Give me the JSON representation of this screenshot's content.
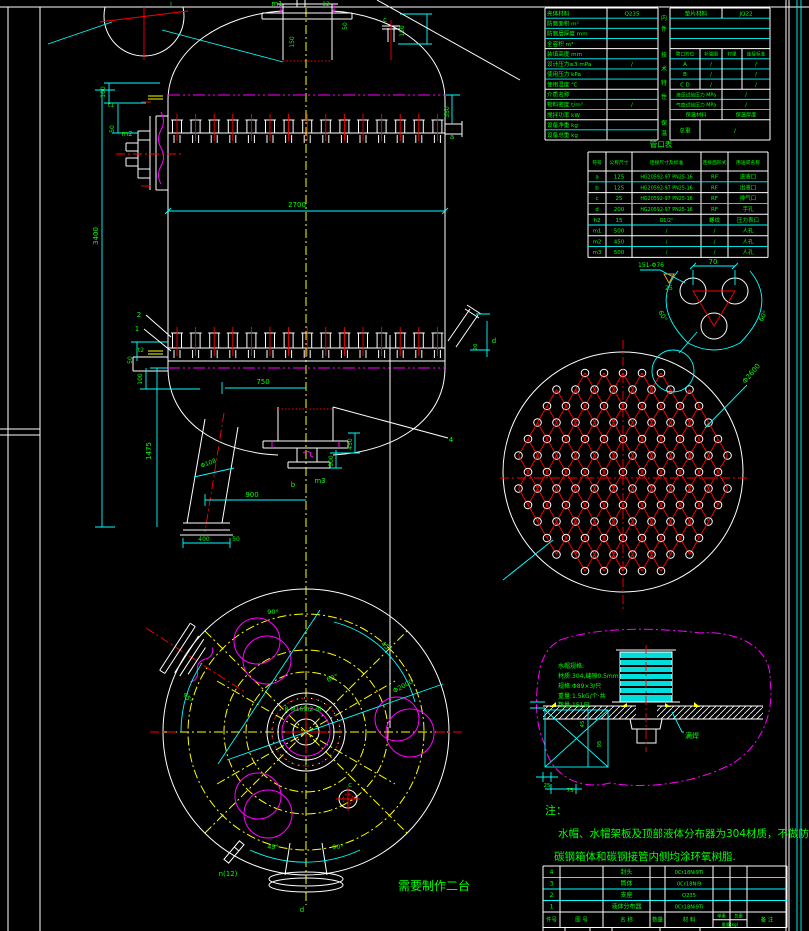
{
  "drawing": {
    "type": "cad-vessel-drawing",
    "subject": "立式容器装配图(带液体分布器与水帽)",
    "production_note": "需要制作二台",
    "detail_balloon": "Ⅰ"
  },
  "colors": {
    "background": "#000000",
    "geometry": "#ffffff",
    "dimensions": "#00ffff",
    "text": "#00ff00",
    "centerline": "#ffff00",
    "phantom": "#ff00ff",
    "holes": "#ff0000",
    "finish_mark": "#e0a030"
  },
  "notes": {
    "label": "注：",
    "line1": "水帽、水帽架板及顶部液体分布器为304材质，不做防腐.",
    "line2": "碳钢箱体和碳钢接管内侧均涂环氧树脂."
  },
  "tech_table": {
    "left_rows": [
      [
        "壳体材料",
        "Q235"
      ],
      [
        "防腐面积 m²",
        ""
      ],
      [
        "防腐层厚度 mm",
        ""
      ],
      [
        "全容积 m³",
        ""
      ],
      [
        "装填高度 mm",
        ""
      ],
      [
        "设计压力≤3 mPa",
        "/"
      ],
      [
        "使用压力 kPa",
        ""
      ],
      [
        "使用温度 ℃",
        ""
      ],
      [
        "介质名称",
        ""
      ],
      [
        "物料密度 t/m³",
        "/"
      ],
      [
        "搅拌功率 kW",
        ""
      ],
      [
        "设备净重 kg",
        ""
      ],
      [
        "设备总重 kg",
        ""
      ]
    ],
    "mid_labels": [
      "内件",
      "技术特性",
      "保温"
    ],
    "right": {
      "gasket_label": "垫片材料",
      "gasket_value": "JQ22",
      "header": [
        "管口方位",
        "补强圈",
        "衬里",
        "连接标准"
      ],
      "abc_rows": [
        [
          "A",
          "/",
          "/"
        ],
        [
          "B",
          "/",
          "/"
        ],
        [
          "C D",
          "/",
          "/"
        ]
      ],
      "hydro_label": "液压试验压力 MPa",
      "hydro_value": "/",
      "air_label": "气密试验压力 MPa",
      "air_value": "/",
      "insul_label": "保温材料",
      "insul_value": "保温厚度",
      "total_label": "总重",
      "total_value": "/"
    }
  },
  "nozzle_table": {
    "title": "管口表",
    "headers": [
      "符号",
      "公称尺寸",
      "连接尺寸及标准",
      "连接面形式",
      "用途或名称"
    ],
    "rows": [
      [
        "a",
        "125",
        "HG20592-97 PN25-16",
        "RF",
        "进液口"
      ],
      [
        "b",
        "125",
        "HG20592-97 PN25-16",
        "RF",
        "出液口"
      ],
      [
        "c",
        "25",
        "HG20592-97 PN25-16",
        "RF",
        "排气口"
      ],
      [
        "d",
        "200",
        "HG20592-97 PN25-16",
        "RF",
        "手孔"
      ],
      [
        "h2",
        "15",
        "G1/2\"",
        "螺纹",
        "压力表口"
      ],
      [
        "m1",
        "500",
        "/",
        "/",
        "人孔"
      ],
      [
        "m2",
        "450",
        "/",
        "/",
        "人孔"
      ],
      [
        "m3",
        "500",
        "/",
        "/",
        "人孔"
      ]
    ]
  },
  "bom_table": {
    "rows": [
      [
        "4",
        "封头",
        "0Cr18Ni9Ti"
      ],
      [
        "3",
        "筒体",
        "0Cr18Ni9"
      ],
      [
        "2",
        "支座",
        "Q235"
      ],
      [
        "1",
        "液体分布器",
        "0Cr18Ni9Ti"
      ]
    ],
    "headers": {
      "no": "件号",
      "dwg": "图 号",
      "name": "名 称",
      "qty": "数量",
      "mat": "材 料",
      "unit_w": "单重",
      "total_w": "总重",
      "weight_unit": "重量(kg)",
      "remark": "备 注"
    }
  },
  "annotations": [
    {
      "t": "m1",
      "x": 277,
      "y": 6
    },
    {
      "t": "12",
      "x": 326,
      "y": 6,
      "s": 6
    },
    {
      "t": "150",
      "x": 294,
      "y": 42,
      "r": -90,
      "s": 6
    },
    {
      "t": "50",
      "x": 347,
      "y": 26,
      "r": -90,
      "s": 6
    },
    {
      "t": "c",
      "x": 385,
      "y": 22
    },
    {
      "t": "150",
      "x": 404,
      "y": 31,
      "r": -90,
      "s": 6
    },
    {
      "t": "350",
      "x": 449,
      "y": 112,
      "r": -90,
      "s": 6
    },
    {
      "t": "a",
      "x": 452,
      "y": 139
    },
    {
      "t": "100",
      "x": 105,
      "y": 92,
      "r": -90,
      "s": 6
    },
    {
      "t": "t1",
      "x": 111,
      "y": 107,
      "s": 6
    },
    {
      "t": "50",
      "x": 114,
      "y": 129,
      "r": -90,
      "s": 6
    },
    {
      "t": "m2",
      "x": 127,
      "y": 136
    },
    {
      "t": "3400",
      "x": 98,
      "y": 236,
      "r": -90
    },
    {
      "t": "2700",
      "x": 297,
      "y": 207
    },
    {
      "t": "2",
      "x": 139,
      "y": 317
    },
    {
      "t": "1",
      "x": 137,
      "y": 331
    },
    {
      "t": "t2",
      "x": 141,
      "y": 352,
      "s": 6
    },
    {
      "t": "50",
      "x": 132,
      "y": 360,
      "r": -90,
      "s": 6
    },
    {
      "t": "100",
      "x": 142,
      "y": 379,
      "r": -90,
      "s": 6
    },
    {
      "t": "1475",
      "x": 151,
      "y": 451,
      "r": -90
    },
    {
      "t": "750",
      "x": 263,
      "y": 384
    },
    {
      "t": "900",
      "x": 252,
      "y": 497
    },
    {
      "t": "Φ108",
      "x": 209,
      "y": 465,
      "r": -20,
      "s": 6
    },
    {
      "t": "450",
      "x": 352,
      "y": 444,
      "r": -90,
      "s": 6
    },
    {
      "t": "300",
      "x": 333,
      "y": 461,
      "r": -90,
      "s": 6
    },
    {
      "t": "b",
      "x": 293,
      "y": 487
    },
    {
      "t": "m3",
      "x": 320,
      "y": 483
    },
    {
      "t": "4",
      "x": 451,
      "y": 442
    },
    {
      "t": "400",
      "x": 204,
      "y": 541,
      "s": 6
    },
    {
      "t": "50",
      "x": 236,
      "y": 541,
      "s": 6
    },
    {
      "t": "d",
      "x": 494,
      "y": 343
    },
    {
      "t": "20",
      "x": 477,
      "y": 347,
      "r": -90,
      "s": 5.5
    },
    {
      "t": "Φ2600",
      "x": 753,
      "y": 375,
      "r": -50
    },
    {
      "t": "70",
      "x": 713,
      "y": 264
    },
    {
      "t": "60°",
      "x": 661,
      "y": 317,
      "r": 60,
      "s": 6.5
    },
    {
      "t": "60°",
      "x": 765,
      "y": 317,
      "r": -60,
      "s": 6.5
    },
    {
      "t": "151-Φ76",
      "x": 651,
      "y": 267,
      "s": 6
    },
    {
      "t": "25",
      "x": 669,
      "y": 290,
      "s": 6
    },
    {
      "t": "90°",
      "x": 273,
      "y": 614,
      "s": 6.5
    },
    {
      "t": "45°",
      "x": 385,
      "y": 648,
      "r": 40,
      "s": 6.5
    },
    {
      "t": "Φ2000",
      "x": 404,
      "y": 688,
      "r": -28,
      "s": 6.5
    },
    {
      "t": "60°",
      "x": 333,
      "y": 680,
      "r": -20,
      "s": 6.5
    },
    {
      "t": "45°",
      "x": 186,
      "y": 699,
      "r": 55,
      "s": 6.5
    },
    {
      "t": "45°",
      "x": 273,
      "y": 849,
      "s": 6.5
    },
    {
      "t": "90°",
      "x": 338,
      "y": 849,
      "s": 6.5
    },
    {
      "t": "n(12)",
      "x": 228,
      "y": 876
    },
    {
      "t": "c",
      "x": 350,
      "y": 787
    },
    {
      "t": "8-M16(n2-d)",
      "x": 303,
      "y": 711,
      "s": 6
    },
    {
      "t": "d",
      "x": 302,
      "y": 912
    },
    {
      "t": "水帽规格:",
      "x": 558,
      "y": 668,
      "s": 6,
      "a": "start"
    },
    {
      "t": "材质:304,缝隙0.5mm",
      "x": 558,
      "y": 678,
      "s": 6,
      "a": "start"
    },
    {
      "t": "规格:Φ89×3/只",
      "x": 558,
      "y": 688,
      "s": 6,
      "a": "start"
    },
    {
      "t": "重量:1.5kG/个·共",
      "x": 558,
      "y": 698,
      "s": 6,
      "a": "start"
    },
    {
      "t": "数量:151只",
      "x": 558,
      "y": 707,
      "s": 6,
      "a": "start"
    },
    {
      "t": "满焊",
      "x": 685,
      "y": 738,
      "a": "start"
    },
    {
      "t": "45",
      "x": 584,
      "y": 724,
      "r": -90,
      "s": 5.5
    },
    {
      "t": "95",
      "x": 601,
      "y": 744,
      "r": -90,
      "s": 5.5
    },
    {
      "t": "25",
      "x": 547,
      "y": 787,
      "s": 5.5
    },
    {
      "t": "75",
      "x": 570,
      "y": 792,
      "s": 5.5
    },
    {
      "t": "Ⅰ",
      "x": 171,
      "y": 6,
      "s": 6
    }
  ]
}
